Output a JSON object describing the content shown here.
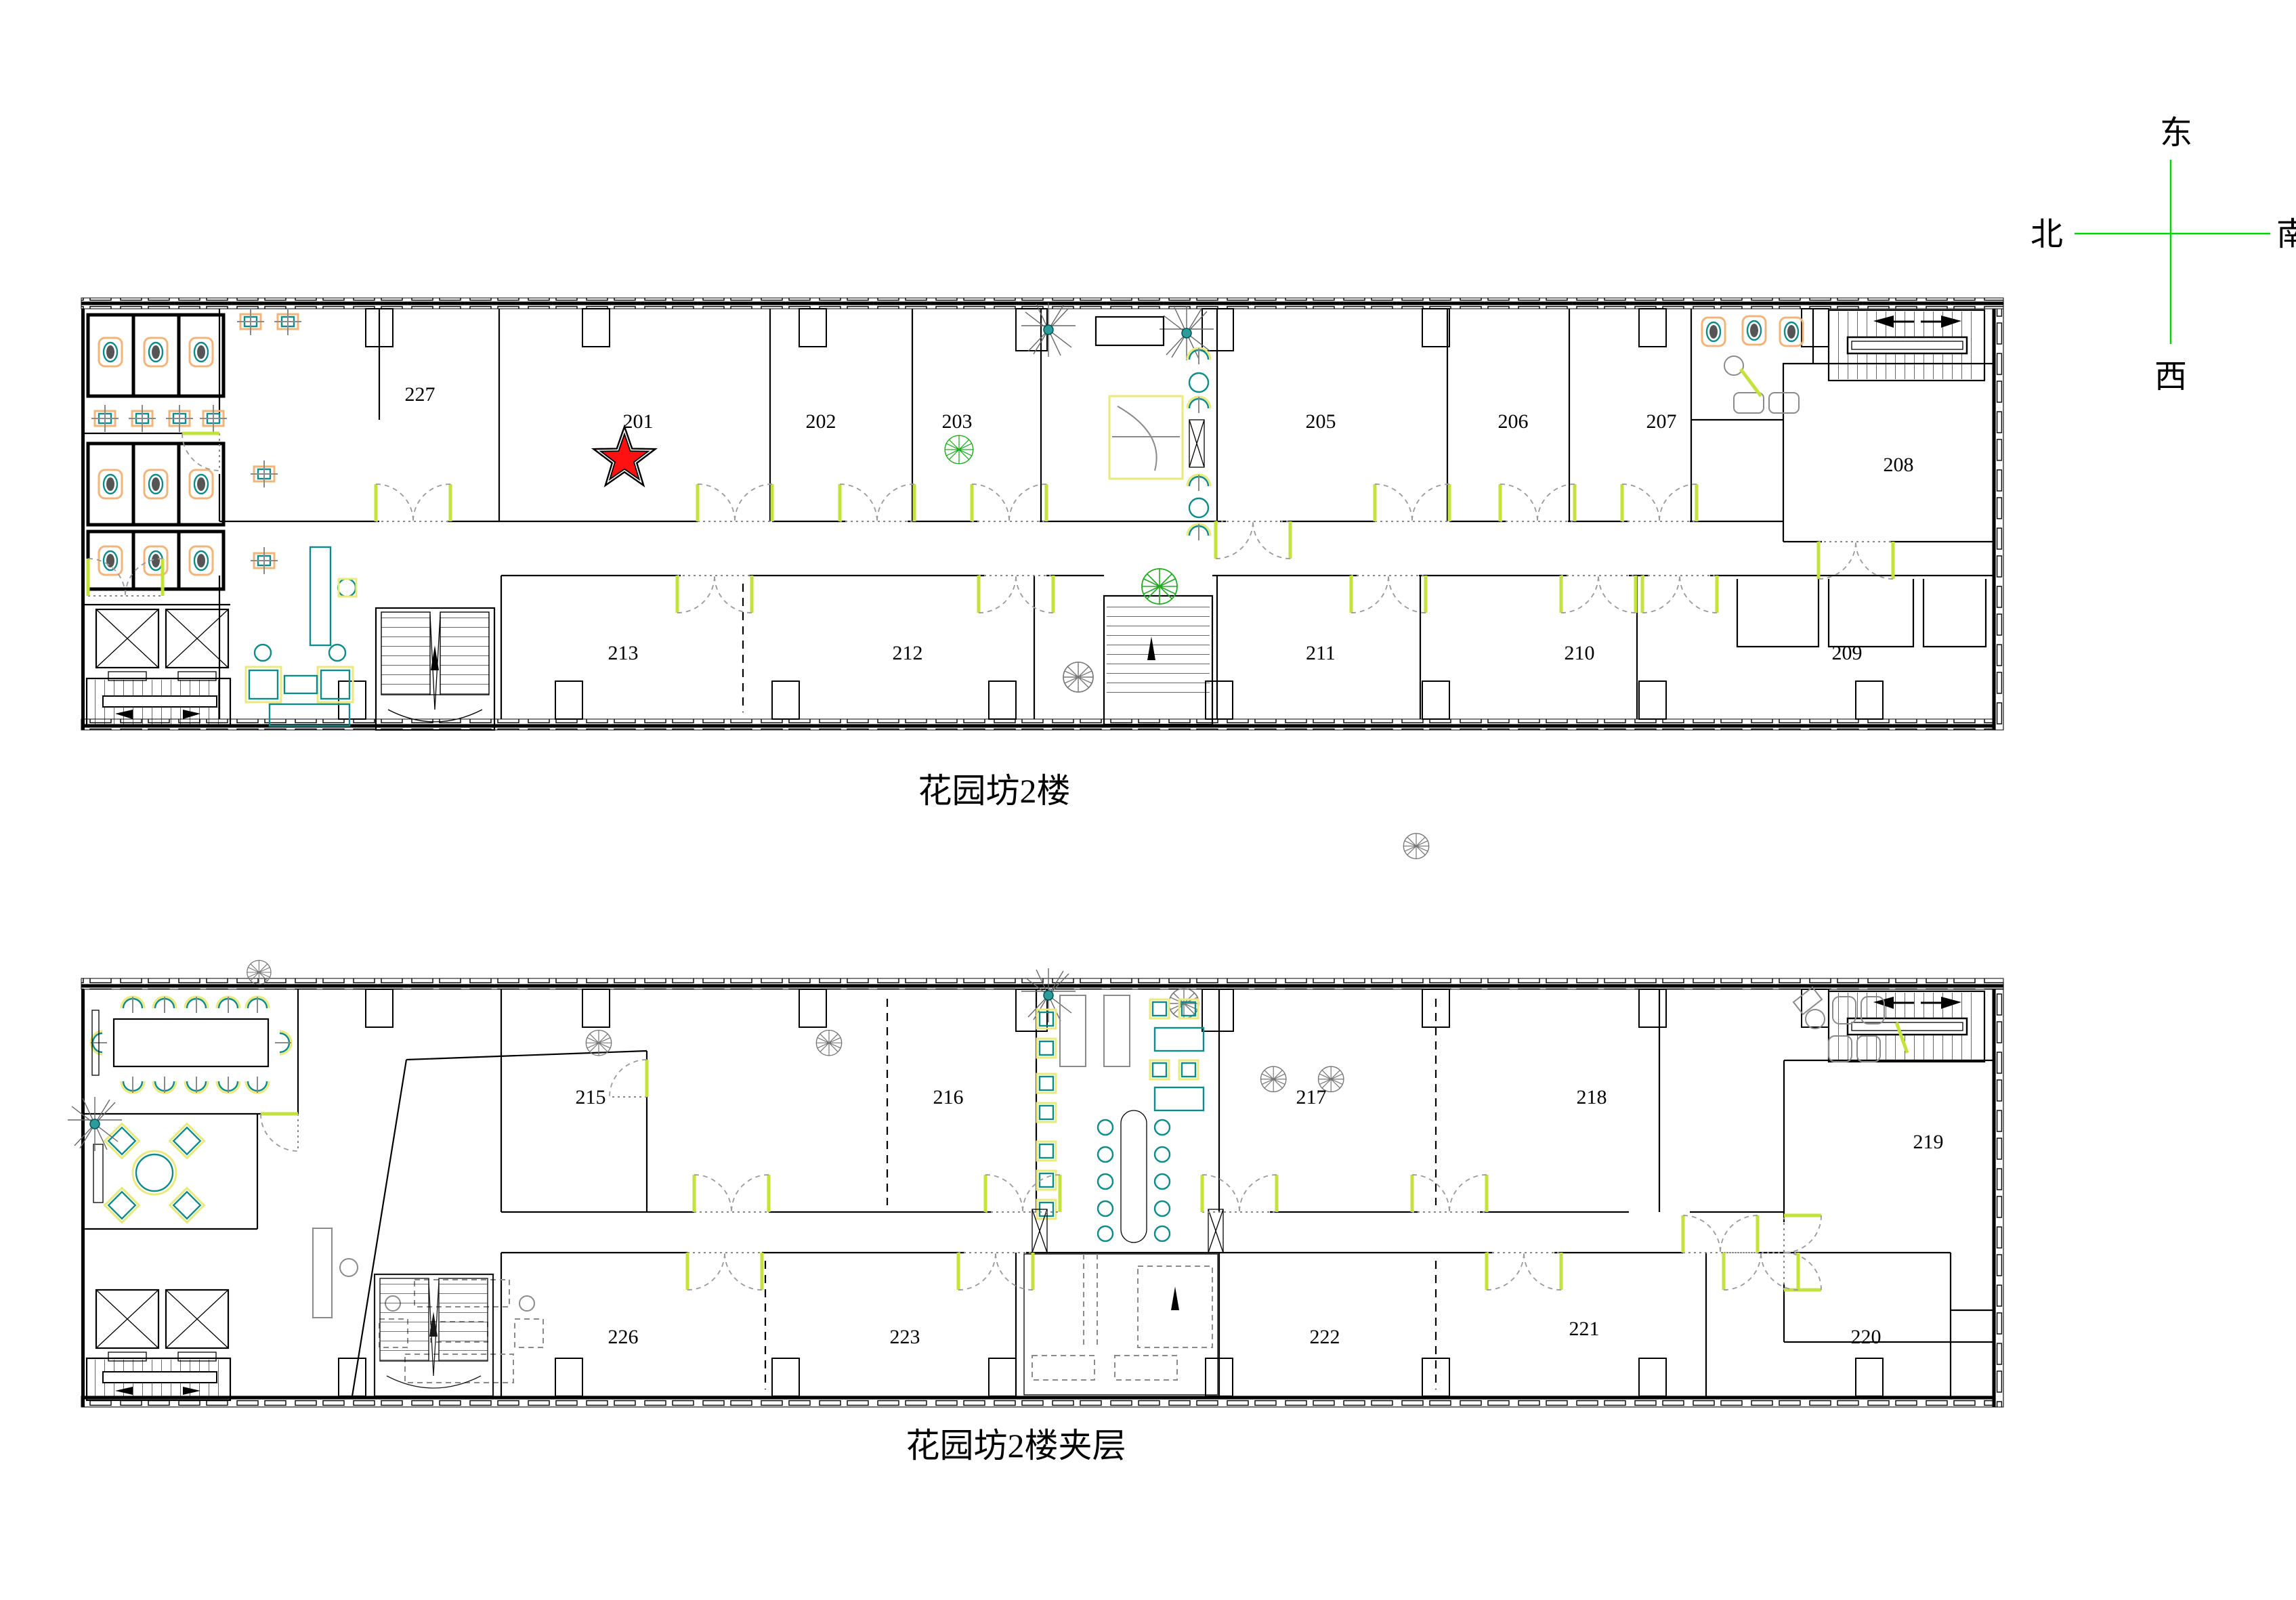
{
  "page": {
    "background": "#ffffff"
  },
  "compass": {
    "east": "东",
    "south": "南",
    "west": "西",
    "north": "北"
  },
  "floor2": {
    "title": "花园坊2楼",
    "rooms_top": [
      {
        "label": "227"
      },
      {
        "label": "201"
      },
      {
        "label": "202"
      },
      {
        "label": "203"
      },
      {
        "label": "205"
      },
      {
        "label": "206"
      },
      {
        "label": "207"
      },
      {
        "label": "208"
      }
    ],
    "rooms_bottom": [
      {
        "label": "213"
      },
      {
        "label": "212"
      },
      {
        "label": "211"
      },
      {
        "label": "210"
      },
      {
        "label": "209"
      }
    ],
    "marker": {
      "shape": "star",
      "room": "201",
      "color": "#ff1111"
    }
  },
  "mezzanine": {
    "title": "花园坊2楼夹层",
    "rooms_top": [
      {
        "label": "215"
      },
      {
        "label": "216"
      },
      {
        "label": "217"
      },
      {
        "label": "218"
      },
      {
        "label": "219"
      }
    ],
    "rooms_bottom": [
      {
        "label": "226"
      },
      {
        "label": "223"
      },
      {
        "label": "222"
      },
      {
        "label": "221"
      },
      {
        "label": "220"
      }
    ]
  },
  "colors": {
    "wall": "#000000",
    "compass_green": "#00d400",
    "door_leaf": "#c3e23a",
    "furniture_teal": "#0d8b8b",
    "fixture_orange": "#f2b478",
    "highlight_yellow": "#e9e97c",
    "plant_green": "#22aa22",
    "star_red": "#ff1111"
  }
}
